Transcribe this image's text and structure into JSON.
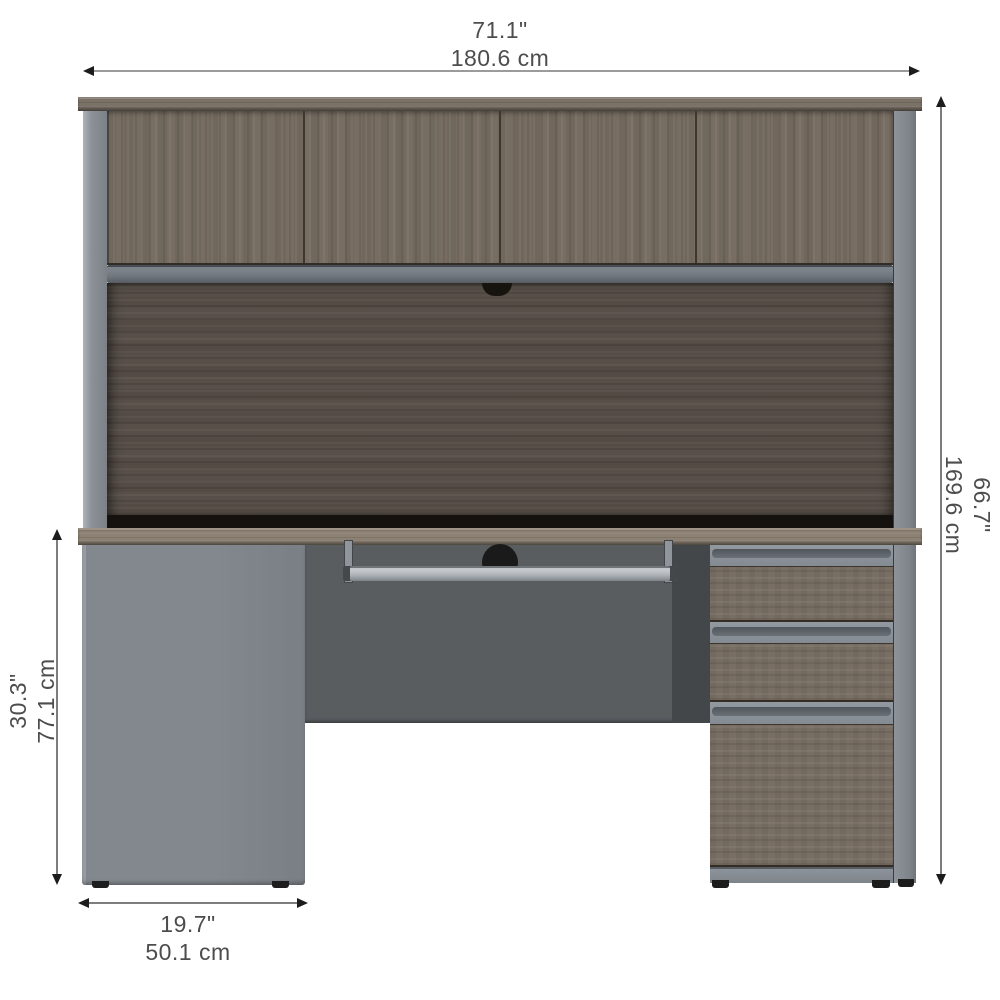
{
  "diagram": {
    "type": "product-dimension-diagram",
    "subject": "office desk with hutch, open shelf, keyboard tray and three-drawer pedestal"
  },
  "dimensions": {
    "overall_width": {
      "inches": "71.1\"",
      "centimeters": "180.6 cm",
      "position": "top"
    },
    "overall_height": {
      "inches": "66.7\"",
      "centimeters": "169.6 cm",
      "position": "right"
    },
    "desk_height": {
      "inches": "30.3\"",
      "centimeters": "77.1 cm",
      "position": "left"
    },
    "pedestal_width": {
      "inches": "19.7\"",
      "centimeters": "50.1 cm",
      "position": "bottom-left"
    }
  },
  "colors": {
    "background": "#ffffff",
    "wood_bark_gray": "#776d62",
    "wood_dark_back_panel": "#574f48",
    "wood_desktop": "#8c8173",
    "slate_gray_panel": "#7e838a",
    "modesty_panel_gray": "#595d60",
    "shadow_black": "#14110e",
    "dimension_line": "#7d7d7d",
    "arrowhead": "#1c1c1c",
    "label_text": "#4d4d4d"
  }
}
